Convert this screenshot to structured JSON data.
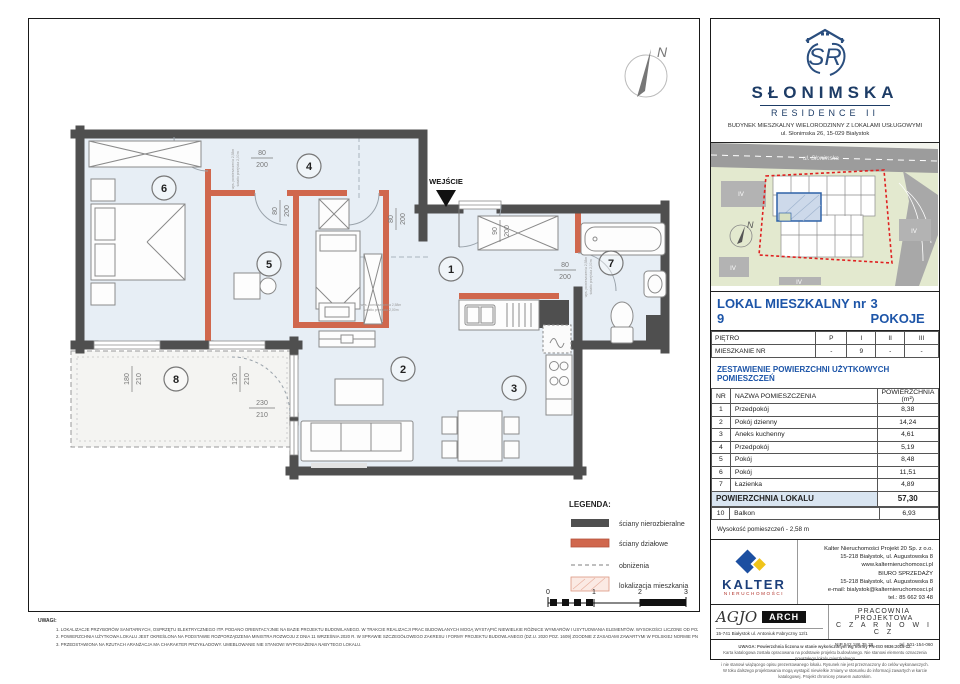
{
  "plan": {
    "entrance_label": "WEJŚCIE",
    "north_label": "N",
    "room_numbers": [
      "1",
      "2",
      "3",
      "4",
      "5",
      "6",
      "7",
      "8"
    ],
    "door_dims": [
      {
        "w": "80",
        "h": "200"
      },
      {
        "w": "80",
        "h": "200"
      },
      {
        "w": "90",
        "h": "200"
      },
      {
        "w": "80",
        "h": "200"
      },
      {
        "w": "80",
        "h": "200"
      }
    ],
    "window_dims": [
      {
        "w": "180",
        "h": "210"
      },
      {
        "w": "120",
        "h": "210"
      },
      {
        "w": "230",
        "h": "210"
      }
    ],
    "annotations": {
      "a1": "wys. pomieszczenia 2,58m",
      "a2": "światło przejścia 2,00m"
    },
    "legend": {
      "title": "LEGENDA:",
      "items": [
        "ściany nierozbieralne",
        "ściany działowe",
        "obniżenia",
        "lokalizacja mieszkania"
      ]
    },
    "scale_ticks": [
      "0",
      "1",
      "2",
      "3"
    ]
  },
  "notes": {
    "title": "UWAGI:",
    "items": [
      "1.    LOKALIZACJE PRZYBORÓW SANITARNYCH, OSPRZĘTU ELEKTRYCZNEGO ITP. PODANO ORIENTACYJNIE NA BAZIE PROJEKTU BUDOWLANEGO. W TRAKCIE REALIZACJI PRAC BUDOWLANYCH MOGĄ WYSTĄPIĆ NIEWIELKIE RÓŻNICE WYMIARÓW I USYTUOWANIA ELEMENTÓW. WYSOKOŚCI LICZONE OD POZIOMU OCZYSZCZONEGO WYKOŃCZENIA PODŁOGI.",
      "2.    POWIERZCHNIA UŻYTKOWA LOKALU JEST OKREŚLONA NA PODSTAWIE ROZPORZĄDZENIA MINISTRA ROZWOJU Z DNIA 11 WRZEŚNIA 2020 R. W SPRAWIE SZCZEGÓŁOWEGO ZAKRESU I FORMY PROJEKTU BUDOWLANEGO (DZ.U. 2020 POZ. 1609) ZGODNIE Z ZASADAMI ZAWARTYMI W POLSKIEJ NORMIE PN-ISO 9836:2015-12.",
      "3.    PRZEDSTAWIONA NA RZUTACH ARANŻACJA MA CHARAKTER PRZYKŁADOWY. UMEBLOWANIE NIE STANOWI WYPOSAŻENIA NABYTEGO LOKALU."
    ]
  },
  "sidebar": {
    "logo": {
      "monogram": "SR",
      "name": "SŁONIMSKA",
      "line2": "RESIDENCE II",
      "desc1": "BUDYNEK MIESZKALNY WIELORODZINNY Z LOKALAMI USŁUGOWYMI",
      "desc2": "ul. Słonimska 26, 15-029 Białystok"
    },
    "map": {
      "street": "ul. Słonimska",
      "labels": [
        "IV",
        "IV",
        "IV",
        "IV"
      ],
      "north": "N"
    },
    "unit": {
      "title": "LOKAL MIESZKALNY  nr 9",
      "rooms": "3 POKOJE"
    },
    "floor_table": {
      "row1": [
        "PIĘTRO",
        "P",
        "I",
        "II",
        "III"
      ],
      "row2": [
        "MIESZKANIE NR",
        "-",
        "9",
        "-",
        "-"
      ]
    },
    "areas": {
      "title": "ZESTAWIENIE POWIERZCHNI UŻYTKOWYCH POMIESZCZEŃ",
      "headers": {
        "nr": "NR",
        "name": "NAZWA POMIESZCZENIA",
        "area": "POWIERZCHNIA (m²)"
      },
      "rows": [
        {
          "nr": "1",
          "name": "Przedpokój",
          "area": "8,38"
        },
        {
          "nr": "2",
          "name": "Pokój dzienny",
          "area": "14,24"
        },
        {
          "nr": "3",
          "name": "Aneks kuchenny",
          "area": "4,61"
        },
        {
          "nr": "4",
          "name": "Przedpokój",
          "area": "5,19"
        },
        {
          "nr": "5",
          "name": "Pokój",
          "area": "8,48"
        },
        {
          "nr": "6",
          "name": "Pokój",
          "area": "11,51"
        },
        {
          "nr": "7",
          "name": "Łazienka",
          "area": "4,89"
        }
      ],
      "total_label": "POWIERZCHNIA LOKALU",
      "total": "57,30",
      "extra": {
        "nr": "10",
        "name": "Balkon",
        "area": "6,93"
      },
      "height_note": "Wysokość pomieszczeń - 2,58 m"
    },
    "kalter": {
      "brand": "KALTER",
      "sub": "NIERUCHOMOŚCI",
      "lines": [
        "Kalter Nieruchomości Projekt 20  Sp. z o.o.",
        "15-218 Białystok, ul. Augustowska 8",
        "www.kalternieruchomosci.pl",
        "BIURO SPRZEDAŻY",
        "15-218 Białystok, ul. Augustowska 8",
        "e-mail: bialystok@kalternieruchomosci.pl",
        "tel.: 85 662 93 48"
      ]
    },
    "agjo": {
      "script": "AGJO",
      "arch": "ARCH",
      "address": "15-741 Białystok   ul. Antoniuk Fabryczny  12/1",
      "studio1": "PRACOWNIA PROJEKTOWA",
      "studio2": "C Z A R N O W I C Z",
      "nip": "NIP  542 186 35 28",
      "tel": "tel. 501-154-060"
    },
    "fine_print": [
      "UWAGA:  Powierzchnia liczona w stanie wykończonym wg normy PN-ISO 9836:2015-12.",
      "Karta katalogowa została opracowana na podstawie projektu budowlanego.  Nie stanowi elementu oznaczenia powstałego lokalu mieszkalnego",
      "i nie stanowi wiążącego opisu prezentowanego lokalu. Rysunek nie jest przeznaczony do celów wykonawczych.",
      "W toku dalszego projektowania mogą wystąpić niewielkie zmiany w stosunku do informacji zawartych w karcie katalogowej.  Projekt chroniony prawem autorskim."
    ]
  }
}
